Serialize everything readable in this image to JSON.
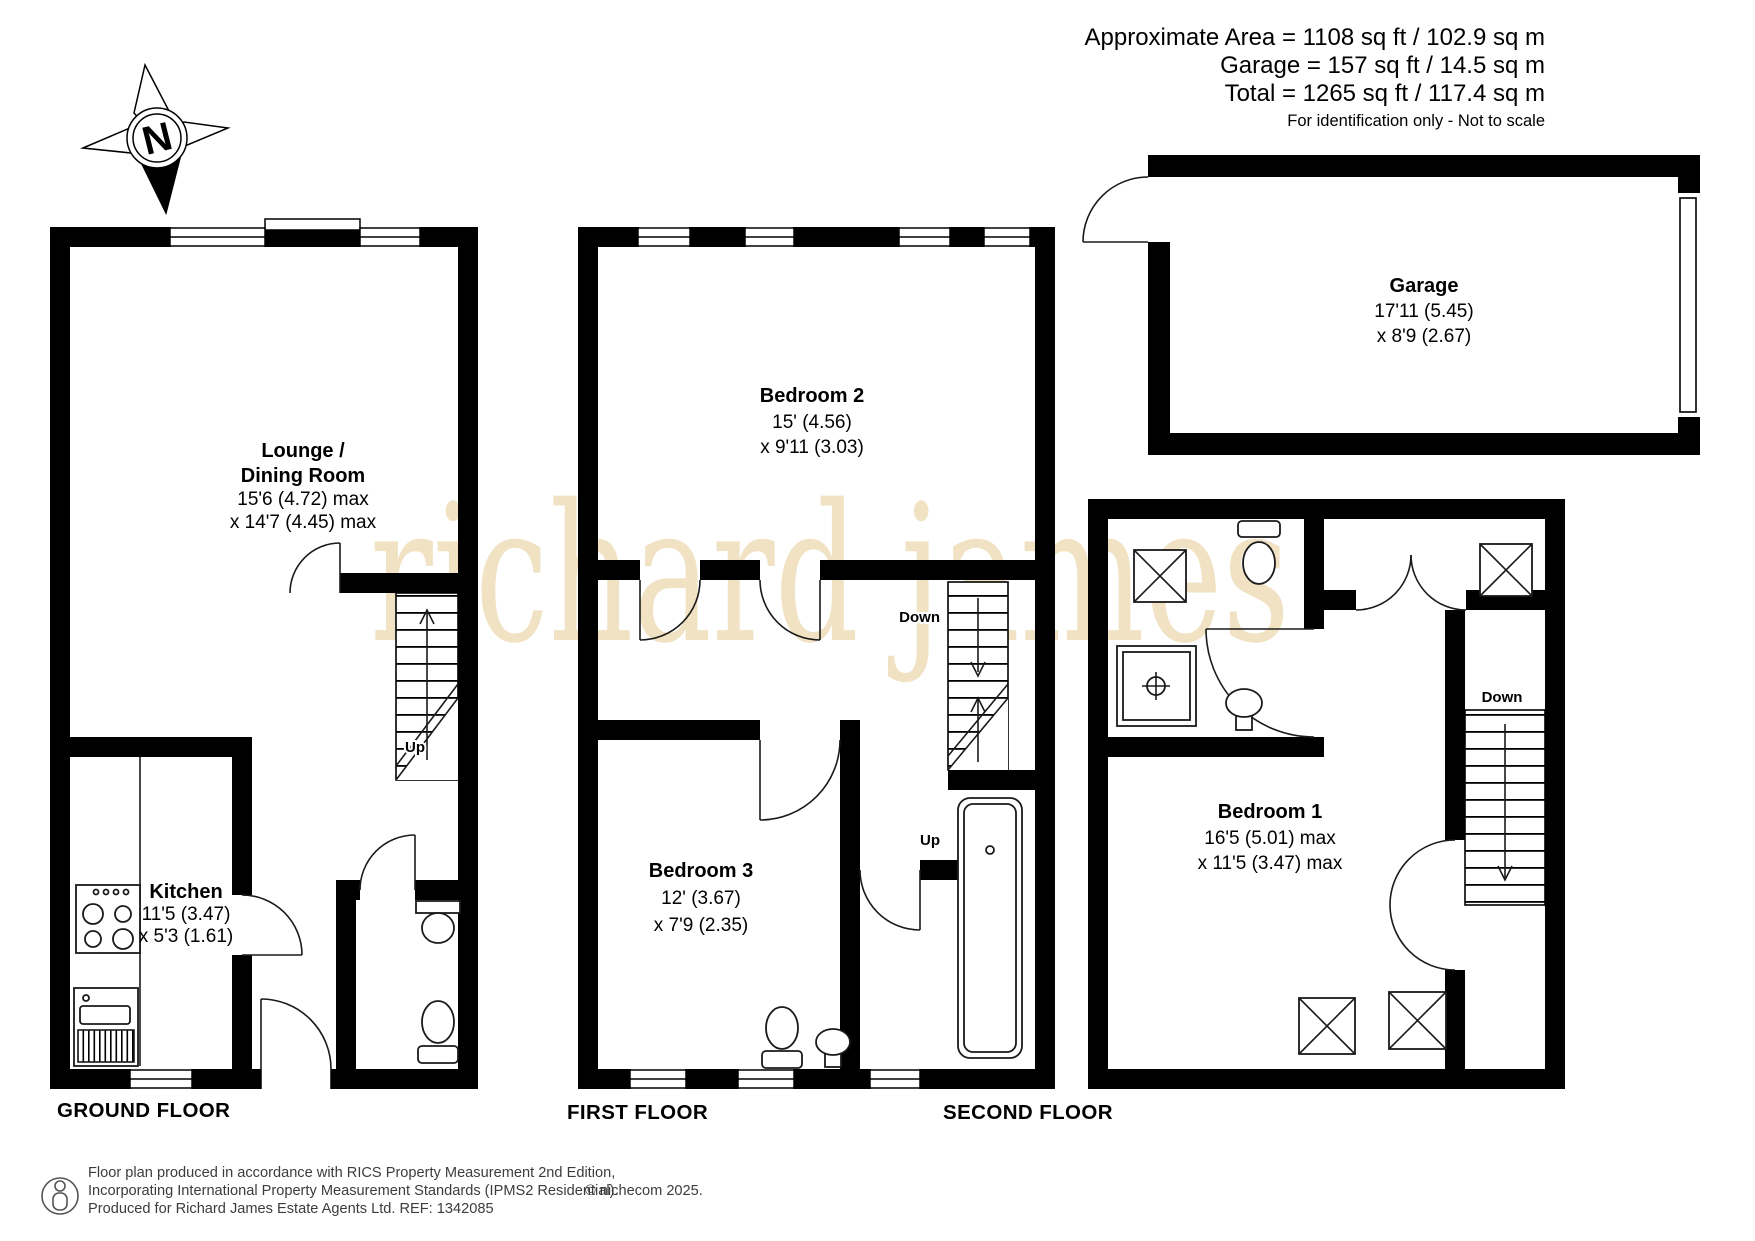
{
  "header": {
    "area_line1": "Approximate Area = 1108 sq ft / 102.9 sq m",
    "area_line2": "Garage = 157 sq ft / 14.5 sq m",
    "area_line3": "Total = 1265 sq ft / 117.4 sq m",
    "disclaimer": "For identification only - Not to scale"
  },
  "compass": {
    "north_letter": "N"
  },
  "watermark": {
    "text": "richard james"
  },
  "floors": {
    "ground": {
      "label": "GROUND FLOOR",
      "lounge": {
        "name1": "Lounge /",
        "name2": "Dining Room",
        "dim1": "15'6 (4.72) max",
        "dim2": "x 14'7 (4.45) max"
      },
      "kitchen": {
        "name": "Kitchen",
        "dim1": "11'5 (3.47)",
        "dim2": "x 5'3 (1.61)"
      },
      "stairs_up": "Up"
    },
    "first": {
      "label": "FIRST FLOOR",
      "bedroom2": {
        "name": "Bedroom 2",
        "dim1": "15' (4.56)",
        "dim2": "x 9'11 (3.03)"
      },
      "bedroom3": {
        "name": "Bedroom 3",
        "dim1": "12' (3.67)",
        "dim2": "x 7'9 (2.35)"
      },
      "stairs_down": "Down",
      "stairs_up": "Up"
    },
    "second": {
      "label": "SECOND FLOOR",
      "bedroom1": {
        "name": "Bedroom 1",
        "dim1": "16'5 (5.01) max",
        "dim2": "x 11'5 (3.47) max"
      },
      "stairs_down": "Down"
    },
    "garage": {
      "name": "Garage",
      "dim1": "17'11 (5.45)",
      "dim2": "x 8'9 (2.67)"
    }
  },
  "footer": {
    "line1": "Floor plan produced in accordance with RICS Property Measurement 2nd Edition,",
    "line2": "Incorporating International Property Measurement Standards (IPMS2 Residential).",
    "copyright": "© nichecom 2025.",
    "line3": "Produced for Richard James Estate Agents Ltd.   REF: 1342085"
  },
  "colors": {
    "wall": "#000000",
    "line": "#1a1a1a",
    "watermark": "#f0e2c3",
    "footer_text": "#3c3c3c",
    "background": "#ffffff"
  }
}
